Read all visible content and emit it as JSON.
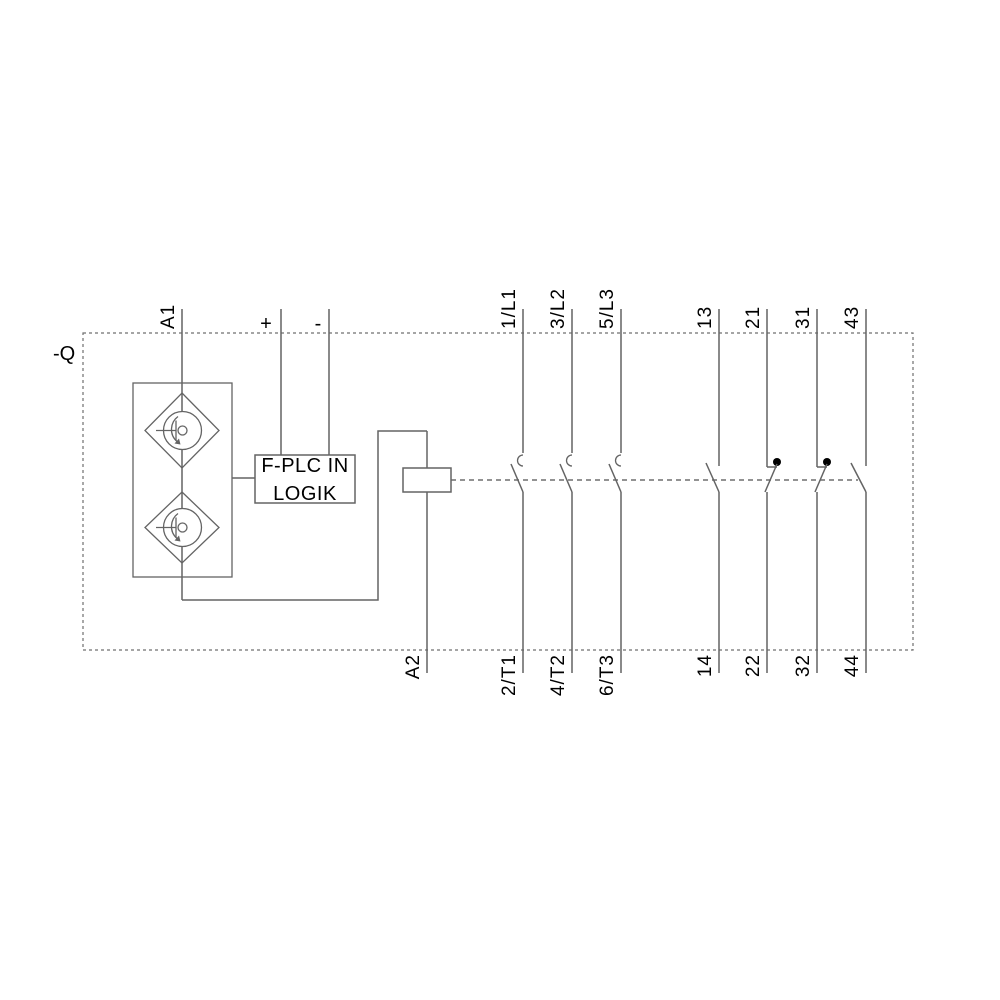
{
  "diagram": {
    "device_tag": "-Q",
    "control": {
      "a1": "A1",
      "a2": "A2",
      "plus": "+",
      "minus": "-"
    },
    "logic_box": {
      "line1": "F-PLC IN",
      "line2": "LOGIK"
    },
    "poles": [
      {
        "top": "1/L1",
        "bottom": "2/T1",
        "type": "main-NO"
      },
      {
        "top": "3/L2",
        "bottom": "4/T2",
        "type": "main-NO"
      },
      {
        "top": "5/L3",
        "bottom": "6/T3",
        "type": "main-NO"
      },
      {
        "top": "13",
        "bottom": "14",
        "type": "aux-NO"
      },
      {
        "top": "21",
        "bottom": "22",
        "type": "aux-NC"
      },
      {
        "top": "31",
        "bottom": "32",
        "type": "aux-NC"
      },
      {
        "top": "43",
        "bottom": "44",
        "type": "aux-NO"
      }
    ],
    "colors": {
      "wire": "#646464",
      "dashed": "#6f6f6f",
      "text": "#000000",
      "background": "#ffffff",
      "contact_dot": "#000000"
    }
  }
}
